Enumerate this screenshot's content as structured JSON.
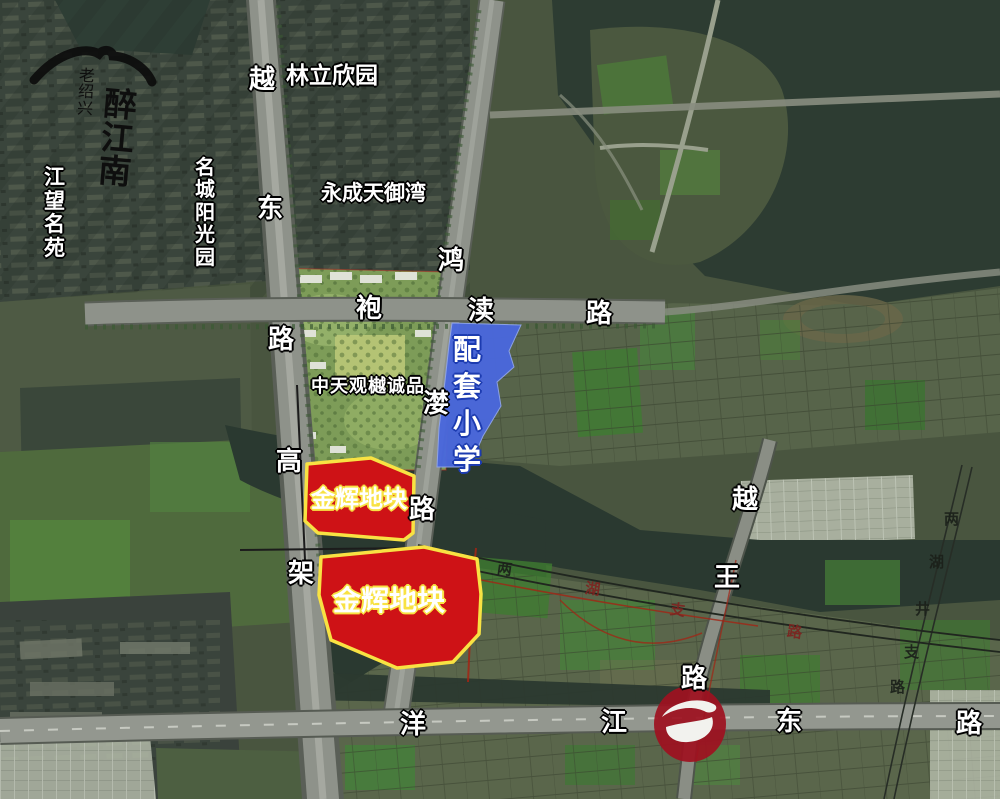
{
  "brand": {
    "calligraphy_small": "老绍兴",
    "calligraphy_large": "醉江南"
  },
  "communities": {
    "jiangwang": "江望名苑",
    "mingcheng": "名城阳光园",
    "linli": "林立欣园",
    "yongcheng": "永成天御湾",
    "zhongtian": "中天观樾诚品"
  },
  "parcels": {
    "school": {
      "label": "配套小学",
      "chars": [
        "配",
        "套",
        "小",
        "学"
      ],
      "fill_color": "#4a68dd"
    },
    "plot_north": {
      "label": "金辉地块",
      "fill_color": "#ce1216",
      "border_color": "#f8e243"
    },
    "plot_south": {
      "label": "金辉地块",
      "fill_color": "#ce1216",
      "border_color": "#f8e243"
    }
  },
  "roads": {
    "yuedong_viaduct": {
      "name": "越东路高架",
      "chars": [
        "越",
        "东",
        "路",
        "高",
        "架"
      ]
    },
    "honglan": {
      "name": "鸿漤路",
      "chars": [
        "鸿",
        "漤",
        "路"
      ]
    },
    "paodu": {
      "name": "袍渎路",
      "chars": [
        "袍",
        "渎",
        "路"
      ]
    },
    "yuewang": {
      "name": "越王路",
      "chars": [
        "越",
        "王",
        "路"
      ]
    },
    "yangjiang_east": {
      "name": "洋江东路",
      "chars": [
        "洋",
        "江",
        "东",
        "路"
      ]
    },
    "lianghu_east_branch": {
      "name": "两湖井支路",
      "chars": [
        "两",
        "湖",
        "井",
        "支",
        "路"
      ]
    },
    "lianghu_south_branch": {
      "name": "两湖支路",
      "chars": [
        "两",
        "湖",
        "支",
        "路"
      ]
    }
  },
  "badge": {
    "color": "#9e1120"
  }
}
